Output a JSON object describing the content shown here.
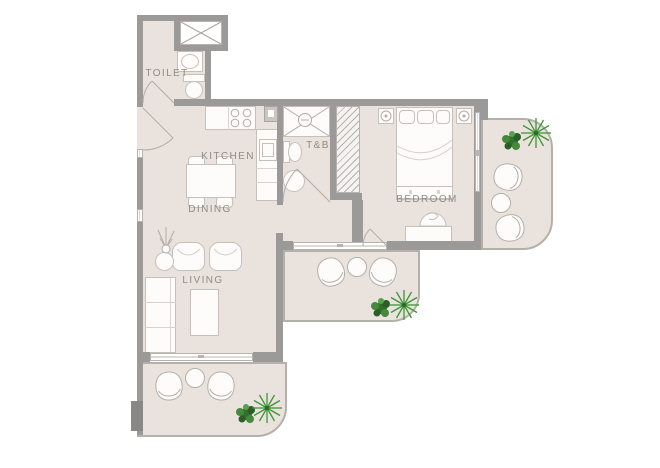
{
  "title": "apartment-floor-plan",
  "rooms": {
    "toilet": {
      "label": "TOILET"
    },
    "kitchen": {
      "label": "KITCHEN"
    },
    "toilet_bath": {
      "label": "T&B"
    },
    "dining": {
      "label": "DINING"
    },
    "bedroom": {
      "label": "BEDROOM"
    },
    "living": {
      "label": "LIVING"
    }
  },
  "colors": {
    "background": "#ffffff",
    "wall": "#9c9a98",
    "floor": "#eae3dd",
    "furniture_fill": "#fdfcfb",
    "furniture_stroke": "#c6c0ba",
    "fixture_stroke": "#b2aca6",
    "label_text": "#8f8b88",
    "plant_bush": "#33702f",
    "plant_bush_light": "#47893c",
    "plant_palm": "#3e9537"
  }
}
